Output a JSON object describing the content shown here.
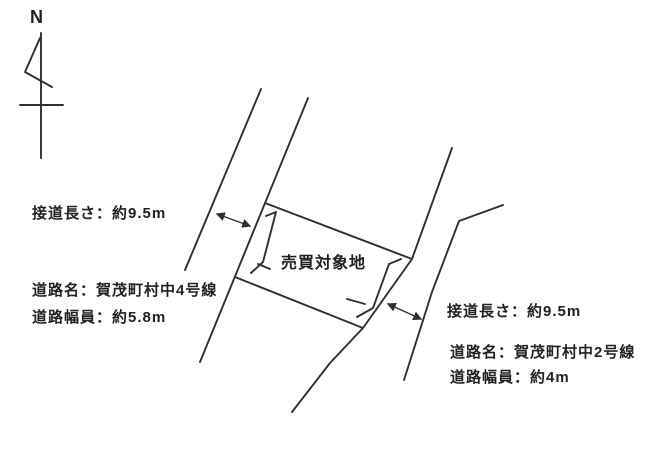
{
  "compass": {
    "label": "N"
  },
  "parcel": {
    "label": "売買対象地"
  },
  "road_left": {
    "frontage_label": "接道長さ：約9.5m",
    "name_label": "道路名：賀茂町村中4号線",
    "width_label": "道路幅員：約5.8m"
  },
  "road_right": {
    "frontage_label": "接道長さ：約9.5m",
    "name_label": "道路名：賀茂町村中2号線",
    "width_label": "道路幅員：約4m"
  },
  "icons": {
    "north_arrow": "north-arrow-icon",
    "dimension_arrows": "double-headed-arrow",
    "frontage_marks": "frontage-bracket"
  },
  "colors": {
    "line": "#352e2e",
    "text": "#242020",
    "background": "#ffffff"
  }
}
